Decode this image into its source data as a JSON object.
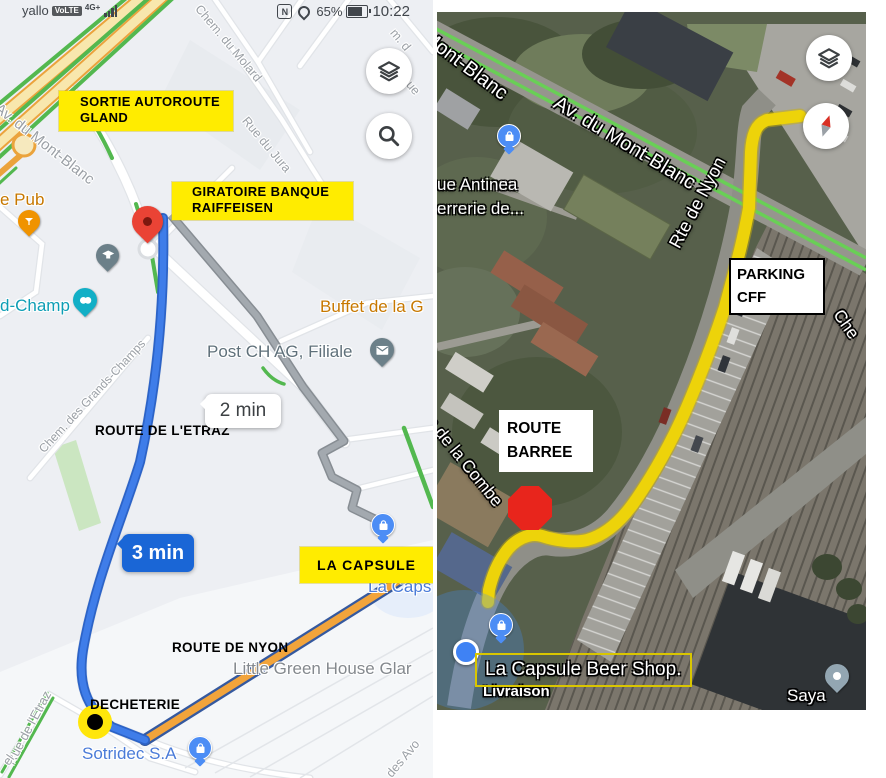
{
  "status_bar": {
    "carrier": "yallo",
    "volte": "VoLTE",
    "network": "4G+",
    "nfc": "N",
    "battery_percent": "65%",
    "time": "10:22"
  },
  "left_map": {
    "boxes": {
      "sortie_line1": "SORTIE AUTOROUTE",
      "sortie_line2": "GLAND",
      "giratoire_line1": "GIRATOIRE BANQUE",
      "giratoire_line2": "RAIFFEISEN",
      "la_capsule": "LA CAPSULE"
    },
    "annotations": {
      "route_etraz": "ROUTE DE L'ETRAZ",
      "route_nyon": "ROUTE DE NYON",
      "decheterie": "DECHETERIE"
    },
    "bubbles": {
      "alt_time": "2 min",
      "main_time": "3 min"
    },
    "poi": {
      "pub": "e Pub",
      "champ": "d-Champ",
      "buffet": "Buffet de la G",
      "post": "Post CH AG, Filiale",
      "little_green": "Little Green House Glar",
      "la_caps": "La Caps",
      "sotridec": "Sotridec S.A"
    },
    "streets": {
      "mont_blanc": "Av. du Mont-Blanc",
      "molard": "Chem. du Molard",
      "jura": "Rue du Jura",
      "grands_champs": "Chem. des Grands-Champs",
      "etraz": "Rue de l'Etraz",
      "avo": "des Avo",
      "frag_m": "m. d",
      "frag_ue": "ue",
      "frag_el": "el"
    }
  },
  "right_map": {
    "streets": {
      "mont_blanc": "Av. du Mont-Blanc",
      "mont_blanc_frag": "Mont-Blanc",
      "rte_nyon": "Rte de Nyon",
      "combe": "ue de la Combe",
      "che": "Che"
    },
    "poi": {
      "antinea": "ue Antinea",
      "errerie": "errerie de...",
      "saya": "Saya",
      "capsule_shop": "La Capsule Beer Shop.",
      "livraison": "Livraison"
    },
    "boxes": {
      "parking_line1": "PARKING",
      "parking_line2": "CFF",
      "barree_line1": "ROUTE",
      "barree_line2": "BARREE"
    }
  },
  "colors": {
    "annotation_yellow": "#FFEC00",
    "route_blue": "#3F7DE9",
    "route_gray": "#A3A9AF",
    "route_orange": "#F2A43B",
    "route_yellow": "#EDD30A",
    "traffic_green": "#53B84F",
    "stop_red": "#E8251C",
    "pin_red": "#EA4335"
  }
}
